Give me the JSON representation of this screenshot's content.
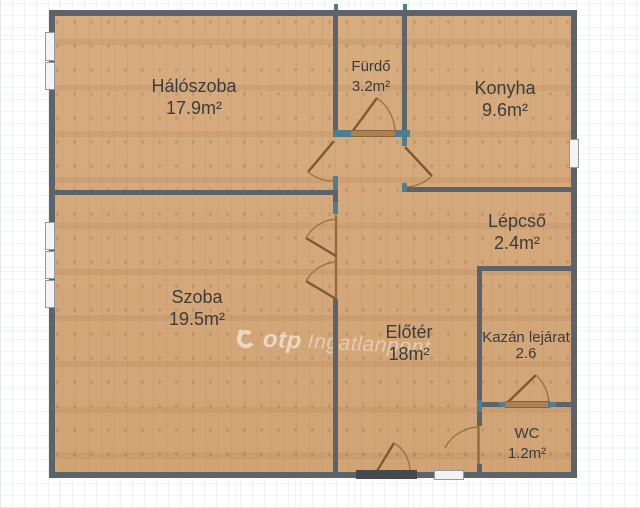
{
  "watermark": {
    "brand": "otp",
    "suffix": "Ingatlanpont"
  },
  "rooms": [
    {
      "id": "haloszoba",
      "name": "Hálószoba",
      "area": "17.9m²"
    },
    {
      "id": "furdo",
      "name": "Fürdő",
      "area": "3.2m²"
    },
    {
      "id": "konyha",
      "name": "Konyha",
      "area": "9.6m²"
    },
    {
      "id": "lepcso",
      "name": "Lépcső",
      "area": "2.4m²"
    },
    {
      "id": "szoba",
      "name": "Szoba",
      "area": "19.5m²"
    },
    {
      "id": "eloter",
      "name": "Előtér",
      "area": "18m²"
    },
    {
      "id": "kazan",
      "name": "Kazán lejárat",
      "area": "2.6"
    },
    {
      "id": "wc",
      "name": "WC",
      "area": "1.2m²"
    }
  ],
  "colors": {
    "floor": "#d5aa7c",
    "wall": "#5c6369",
    "jamb_teal": "#4e7e90",
    "door_brown": "#8a6238",
    "label_text": "#3c3c3c",
    "background": "#ffffff"
  }
}
